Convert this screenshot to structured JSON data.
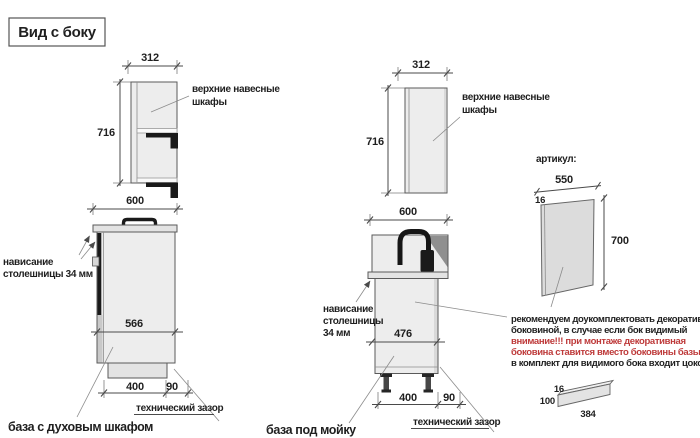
{
  "title": "Вид с боку",
  "wall_cabinet_left": {
    "width": "312",
    "height": "716",
    "label1": "верхние навесные",
    "label2": "шкафы"
  },
  "wall_cabinet_mid": {
    "width": "312",
    "height": "716",
    "label1": "верхние навесные",
    "label2": "шкафы"
  },
  "base_oven": {
    "depth": "600",
    "inner": "566",
    "bottom": "400",
    "gap": "90",
    "gap_label": "технический зазор",
    "overhang1": "нависание",
    "overhang2": "столешницы 34 мм",
    "caption": "база с духовым шкафом"
  },
  "base_sink": {
    "depth": "600",
    "inner": "476",
    "bottom": "400",
    "gap": "90",
    "gap_label": "технический зазор",
    "overhang1": "нависание",
    "overhang2": "столешницы",
    "overhang3": "34 мм",
    "caption": "база под мойку"
  },
  "panel": {
    "header": "артикул:",
    "width": "550",
    "thickness": "16",
    "height": "700"
  },
  "note": {
    "line1": "рекомендуем доукомплектовать декоративной",
    "line2": "боковиной, в случае если бок видимый",
    "line3": "внимание!!! при монтаже декоративная",
    "line4": "боковина ставится вместо боковины базы лдсп",
    "line5": "в комплект для видимого бока входит цоколь:"
  },
  "plinth_panel": {
    "thickness": "16",
    "height": "100",
    "length": "384"
  },
  "colors": {
    "line": "#4a4a4a",
    "text": "#1f1f1f",
    "dark": "#1a1a1a",
    "red": "#be3a3a",
    "cabinet_fill": "#ededed",
    "panel_fill": "#dcdcdc"
  }
}
